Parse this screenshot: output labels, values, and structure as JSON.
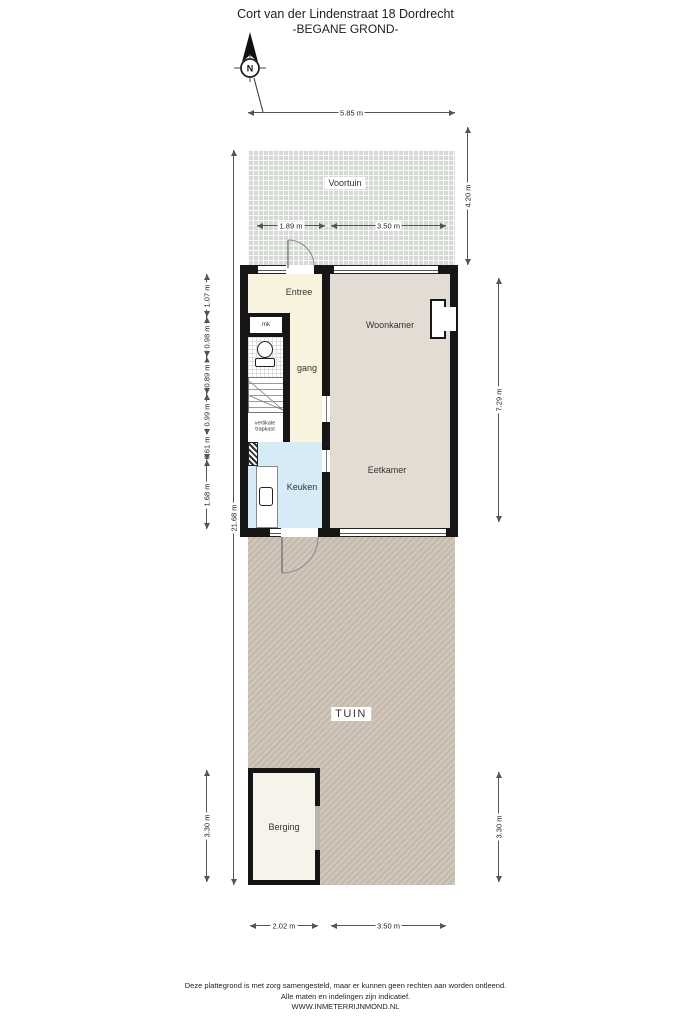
{
  "header": {
    "title": "Cort van der Lindenstraat 18 Dordrecht",
    "subtitle": "-BEGANE GROND-"
  },
  "compass": {
    "north_label": "N"
  },
  "rooms": {
    "voortuin": "Voortuin",
    "entree": "Entree",
    "meterkast": "mk",
    "gang": "gang",
    "woonkamer": "Woonkamer",
    "keuken": "Keuken",
    "eetkamer": "Eetkamer",
    "trapkast": "vertikale trapkast",
    "tuin": "TUIN",
    "berging": "Berging"
  },
  "dimensions": {
    "plot_width_top": "5.85 m",
    "voortuin_door_left": "1.89 m",
    "voortuin_door_right": "3.50 m",
    "voortuin_depth": "4.20 m",
    "house_depth": "7.29 m",
    "plot_depth_total": "21.68 m",
    "left_segments": [
      "1.07 m",
      "0.98 m",
      "0.89 m",
      "0.99 m",
      "0.61 m",
      "1.68 m"
    ],
    "berging_depth_left": "3.30 m",
    "berging_depth_right": "3.30 m",
    "berging_width_bottom": "2.02 m",
    "tuin_width_bottom": "3.50 m"
  },
  "footer": {
    "line1": "Deze plattegrond is met zorg samengesteld, maar er kunnen geen rechten aan worden ontleend.",
    "line2": "Alle maten en indelingen zijn indicatief.",
    "line3": "WWW.INMETERRIJNMOND.NL"
  },
  "colors": {
    "wall": "#161616",
    "entree_gang": "#f8f3df",
    "living": "#e3dcd2",
    "keuken": "#d7ebf6",
    "voortuin": "#d6dad5",
    "tuin_base": "#cfc5ba",
    "tuin_stripe": "#c3b6a9",
    "berging": "#f6f3ea"
  }
}
